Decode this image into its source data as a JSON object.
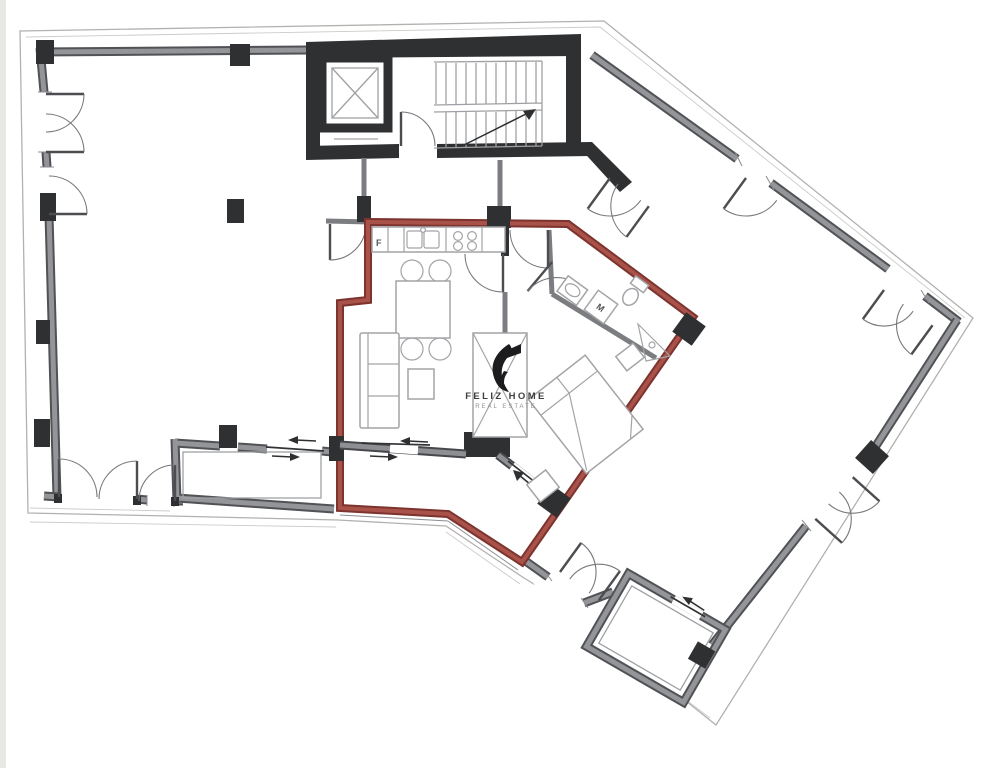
{
  "meta": {
    "type": "real-estate floor plan"
  },
  "watermark": {
    "brand": "FELIZ HOME",
    "tagline": "REAL ESTATE"
  },
  "labels": {
    "fridge": "F",
    "washing_machine": "M"
  },
  "colors": {
    "page_bg": "#ffffff",
    "page_edge": "#eae8e5",
    "site_line": "#b3b1ae",
    "wall_gray_edge": "#515256",
    "wall_gray_core": "#949599",
    "wall_dark": "#47484c",
    "wall_black": "#2f3032",
    "unit_red_edge": "#7d332e",
    "unit_red_core": "#a8524a",
    "furniture_line": "#a3a4a7",
    "door_line": "#77787c",
    "text_dark": "#3f3f41",
    "text_gray": "#909092"
  }
}
